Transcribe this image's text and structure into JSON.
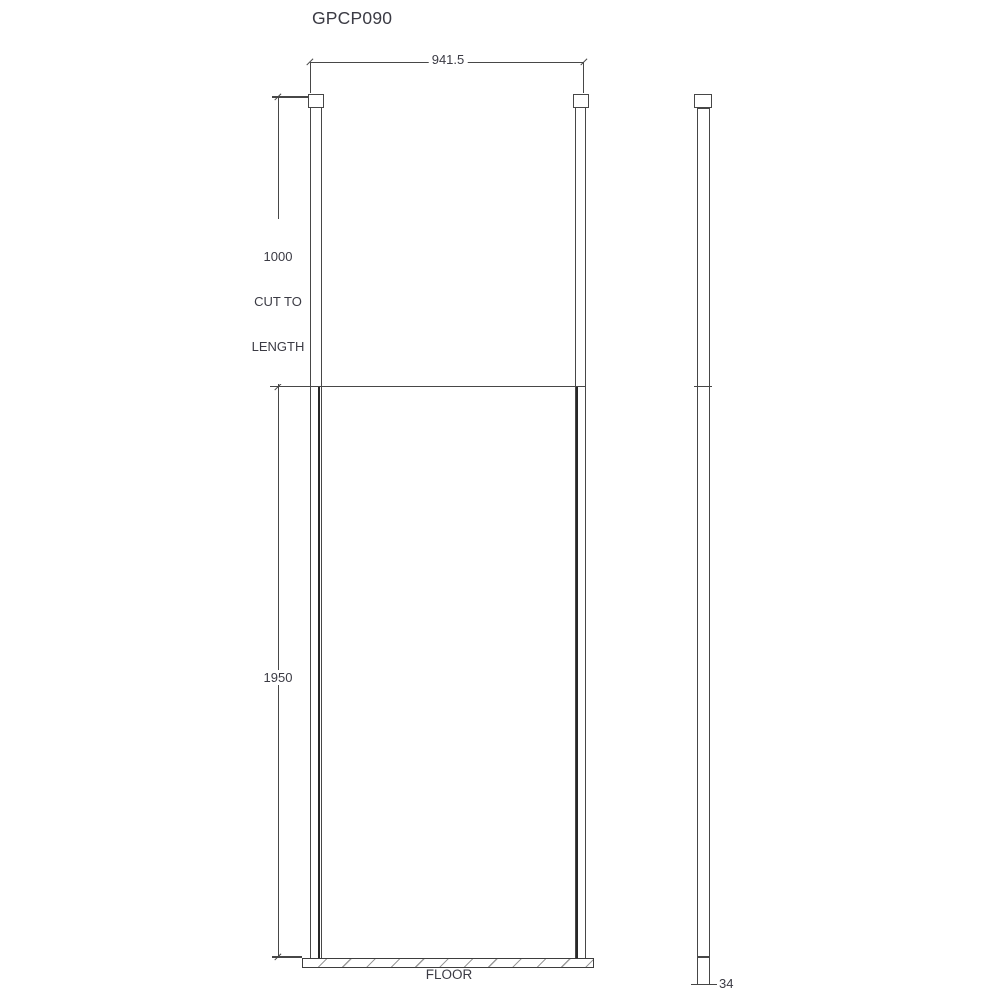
{
  "title": "GPCP090",
  "dimensions": {
    "overall_width": "941.5",
    "post_cut": {
      "value": "1000",
      "line2": "CUT TO",
      "line3": "LENGTH"
    },
    "panel_height": "1950",
    "profile_depth": "34"
  },
  "labels": {
    "floor": "FLOOR"
  },
  "colors": {
    "line": "#474747",
    "glass_edge": "#272727",
    "text": "#3b3b44",
    "hatch": "#9a9a9a",
    "background": "#ffffff"
  }
}
